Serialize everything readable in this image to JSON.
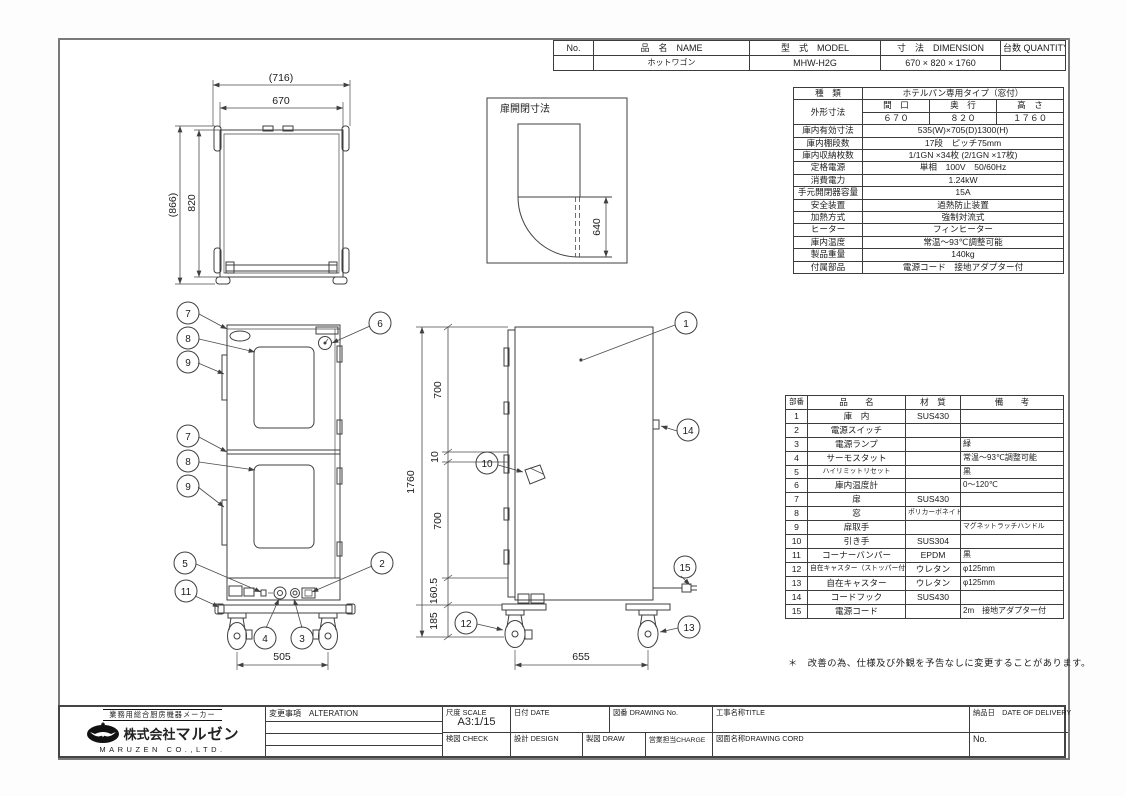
{
  "header": {
    "col_no": "No.",
    "col_name": "品　名　NAME",
    "col_model": "型　式　MODEL",
    "col_dim": "寸　法　DIMENSION",
    "col_qty": "台数 QUANTITY",
    "name": "ホットワゴン",
    "model": "MHW-H2G",
    "dimension": "670 × 820 × 1760"
  },
  "spec": {
    "kind_label": "種　類",
    "kind_value": "ホテルパン専用タイプ（窓付）",
    "outer_label": "外形寸法",
    "outer_cols": [
      "間　口",
      "奥　行",
      "高　さ"
    ],
    "outer_vals": [
      "６７０",
      "８２０",
      "１７６０"
    ],
    "rows": [
      {
        "label": "庫内有効寸法",
        "value": "535(W)×705(D)1300(H)"
      },
      {
        "label": "庫内棚段数",
        "value": "17段　ピッチ75mm"
      },
      {
        "label": "庫内収納枚数",
        "value": "1/1GN ×34枚 (2/1GN ×17枚)"
      },
      {
        "label": "定格電源",
        "value": "単相　100V　50/60Hz"
      },
      {
        "label": "消費電力",
        "value": "1.24kW"
      },
      {
        "label": "手元開閉器容量",
        "value": "15A"
      },
      {
        "label": "安全装置",
        "value": "過熱防止装置"
      },
      {
        "label": "加熱方式",
        "value": "強制対流式"
      },
      {
        "label": "ヒーター",
        "value": "フィンヒーター"
      },
      {
        "label": "庫内温度",
        "value": "常温～93℃調整可能"
      },
      {
        "label": "製品重量",
        "value": "140kg"
      },
      {
        "label": "付属部品",
        "value": "電源コード　接地アダプター付"
      }
    ]
  },
  "parts": {
    "cols": [
      "部番",
      "品　　名",
      "材　質",
      "備　　考"
    ],
    "rows": [
      [
        "1",
        "庫　内",
        "SUS430",
        ""
      ],
      [
        "2",
        "電源スイッチ",
        "",
        ""
      ],
      [
        "3",
        "電源ランプ",
        "",
        "緑"
      ],
      [
        "4",
        "サーモスタット",
        "",
        "常温～93℃調整可能"
      ],
      [
        "5",
        "ハイリミットリセット",
        "",
        "黒"
      ],
      [
        "6",
        "庫内温度計",
        "",
        "0～120℃"
      ],
      [
        "7",
        "扉",
        "SUS430",
        ""
      ],
      [
        "8",
        "窓",
        "ポリカーボネイト",
        ""
      ],
      [
        "9",
        "扉取手",
        "",
        "マグネットラッチハンドル"
      ],
      [
        "10",
        "引き手",
        "SUS304",
        ""
      ],
      [
        "11",
        "コーナーバンパー",
        "EPDM",
        "黒"
      ],
      [
        "12",
        "自在キャスター（ストッパー付）",
        "ウレタン",
        "φ125mm"
      ],
      [
        "13",
        "自在キャスター",
        "ウレタン",
        "φ125mm"
      ],
      [
        "14",
        "コードフック",
        "SUS430",
        ""
      ],
      [
        "15",
        "電源コード",
        "",
        "2m　接地アダプター付"
      ]
    ]
  },
  "note": "＊　改善の為、仕様及び外観を予告なしに変更することがあります。",
  "views": {
    "plan": {
      "d_outer_w": "(716)",
      "d_w": "670",
      "d_outer_d": "(866)",
      "d_d": "820"
    },
    "door": {
      "title": "扉開閉寸法",
      "d_open": "640"
    },
    "front": {
      "d_span": "505",
      "callouts": [
        "7",
        "8",
        "9",
        "7",
        "8",
        "9",
        "5",
        "11",
        "6",
        "2",
        "4",
        "3"
      ]
    },
    "side": {
      "d_total": "1760",
      "d_top": "700",
      "d_gap": "10",
      "d_bot": "700",
      "d_base": "160.5",
      "d_caster": "185",
      "d_span": "655",
      "callouts": [
        "1",
        "14",
        "10",
        "15",
        "12",
        "13"
      ]
    }
  },
  "company": {
    "tagline": "業務用総合厨房機器メーカー",
    "name_prefix": "株式会社",
    "name": "マルゼン",
    "name_en": "MARUZEN CO.,LTD."
  },
  "titleblock": {
    "alteration": "変更事項　ALTERATION",
    "scale_label": "尺度 SCALE",
    "scale": "A3:1/15",
    "date_label": "日付 DATE",
    "dwg_no_label": "図番 DRAWING No.",
    "title_label": "工事名称TITLE",
    "delivery_label": "納品日　DATE OF DELIVERY",
    "check_label": "検図 CHECK",
    "design_label": "設計 DESIGN",
    "draw_label": "製図 DRAW",
    "charge_label": "営業担当CHARGE",
    "dwg_name_label": "図面名称DRAWING CORD",
    "no_label": "No."
  }
}
